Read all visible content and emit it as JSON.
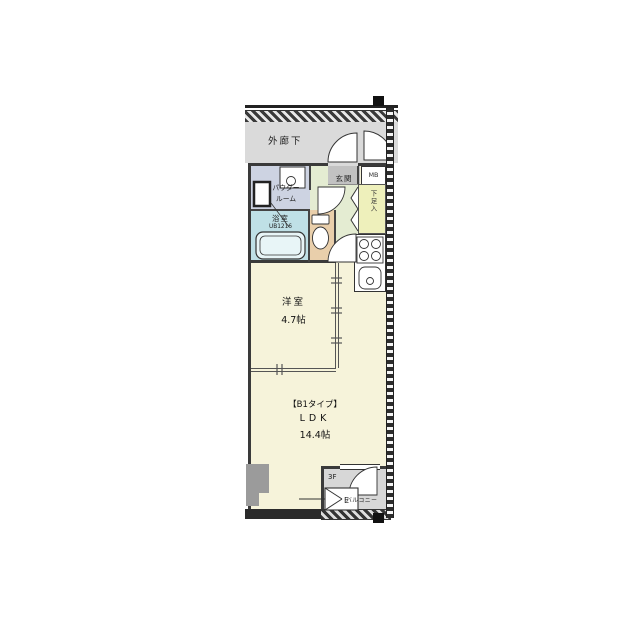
{
  "plan": {
    "corridor": {
      "label": "外廊下"
    },
    "entrance": {
      "label": "玄関"
    },
    "meter_box": {
      "label": "MB"
    },
    "powder_room": {
      "label_line1": "パウダー",
      "label_line2": "ルーム"
    },
    "bathroom": {
      "label": "浴室",
      "unit_bath_size": "UB1216"
    },
    "shoe_storage": {
      "label": "下足入"
    },
    "western_room": {
      "label": "洋室",
      "size": "4.7帖"
    },
    "ldk": {
      "type_label": "【B1タイプ】",
      "label": "LDK",
      "size": "14.4帖"
    },
    "balcony": {
      "label": "バルコニー",
      "floor": "3F",
      "escape_hatch_label": "E"
    },
    "colors": {
      "room_cream": "#f6f3da",
      "powder_room": "#cdd3e2",
      "bathroom": "#bfe0e6",
      "toilet": "#e9cfab",
      "hallway_green": "#e4ecd2",
      "shoe_storage_yellow": "#eef0bb",
      "corridor_gray": "#dadada",
      "entrance_gray": "#c2c2c2",
      "balcony_gray": "#d7d7d7",
      "wall_dark": "#3a3a3a"
    }
  }
}
